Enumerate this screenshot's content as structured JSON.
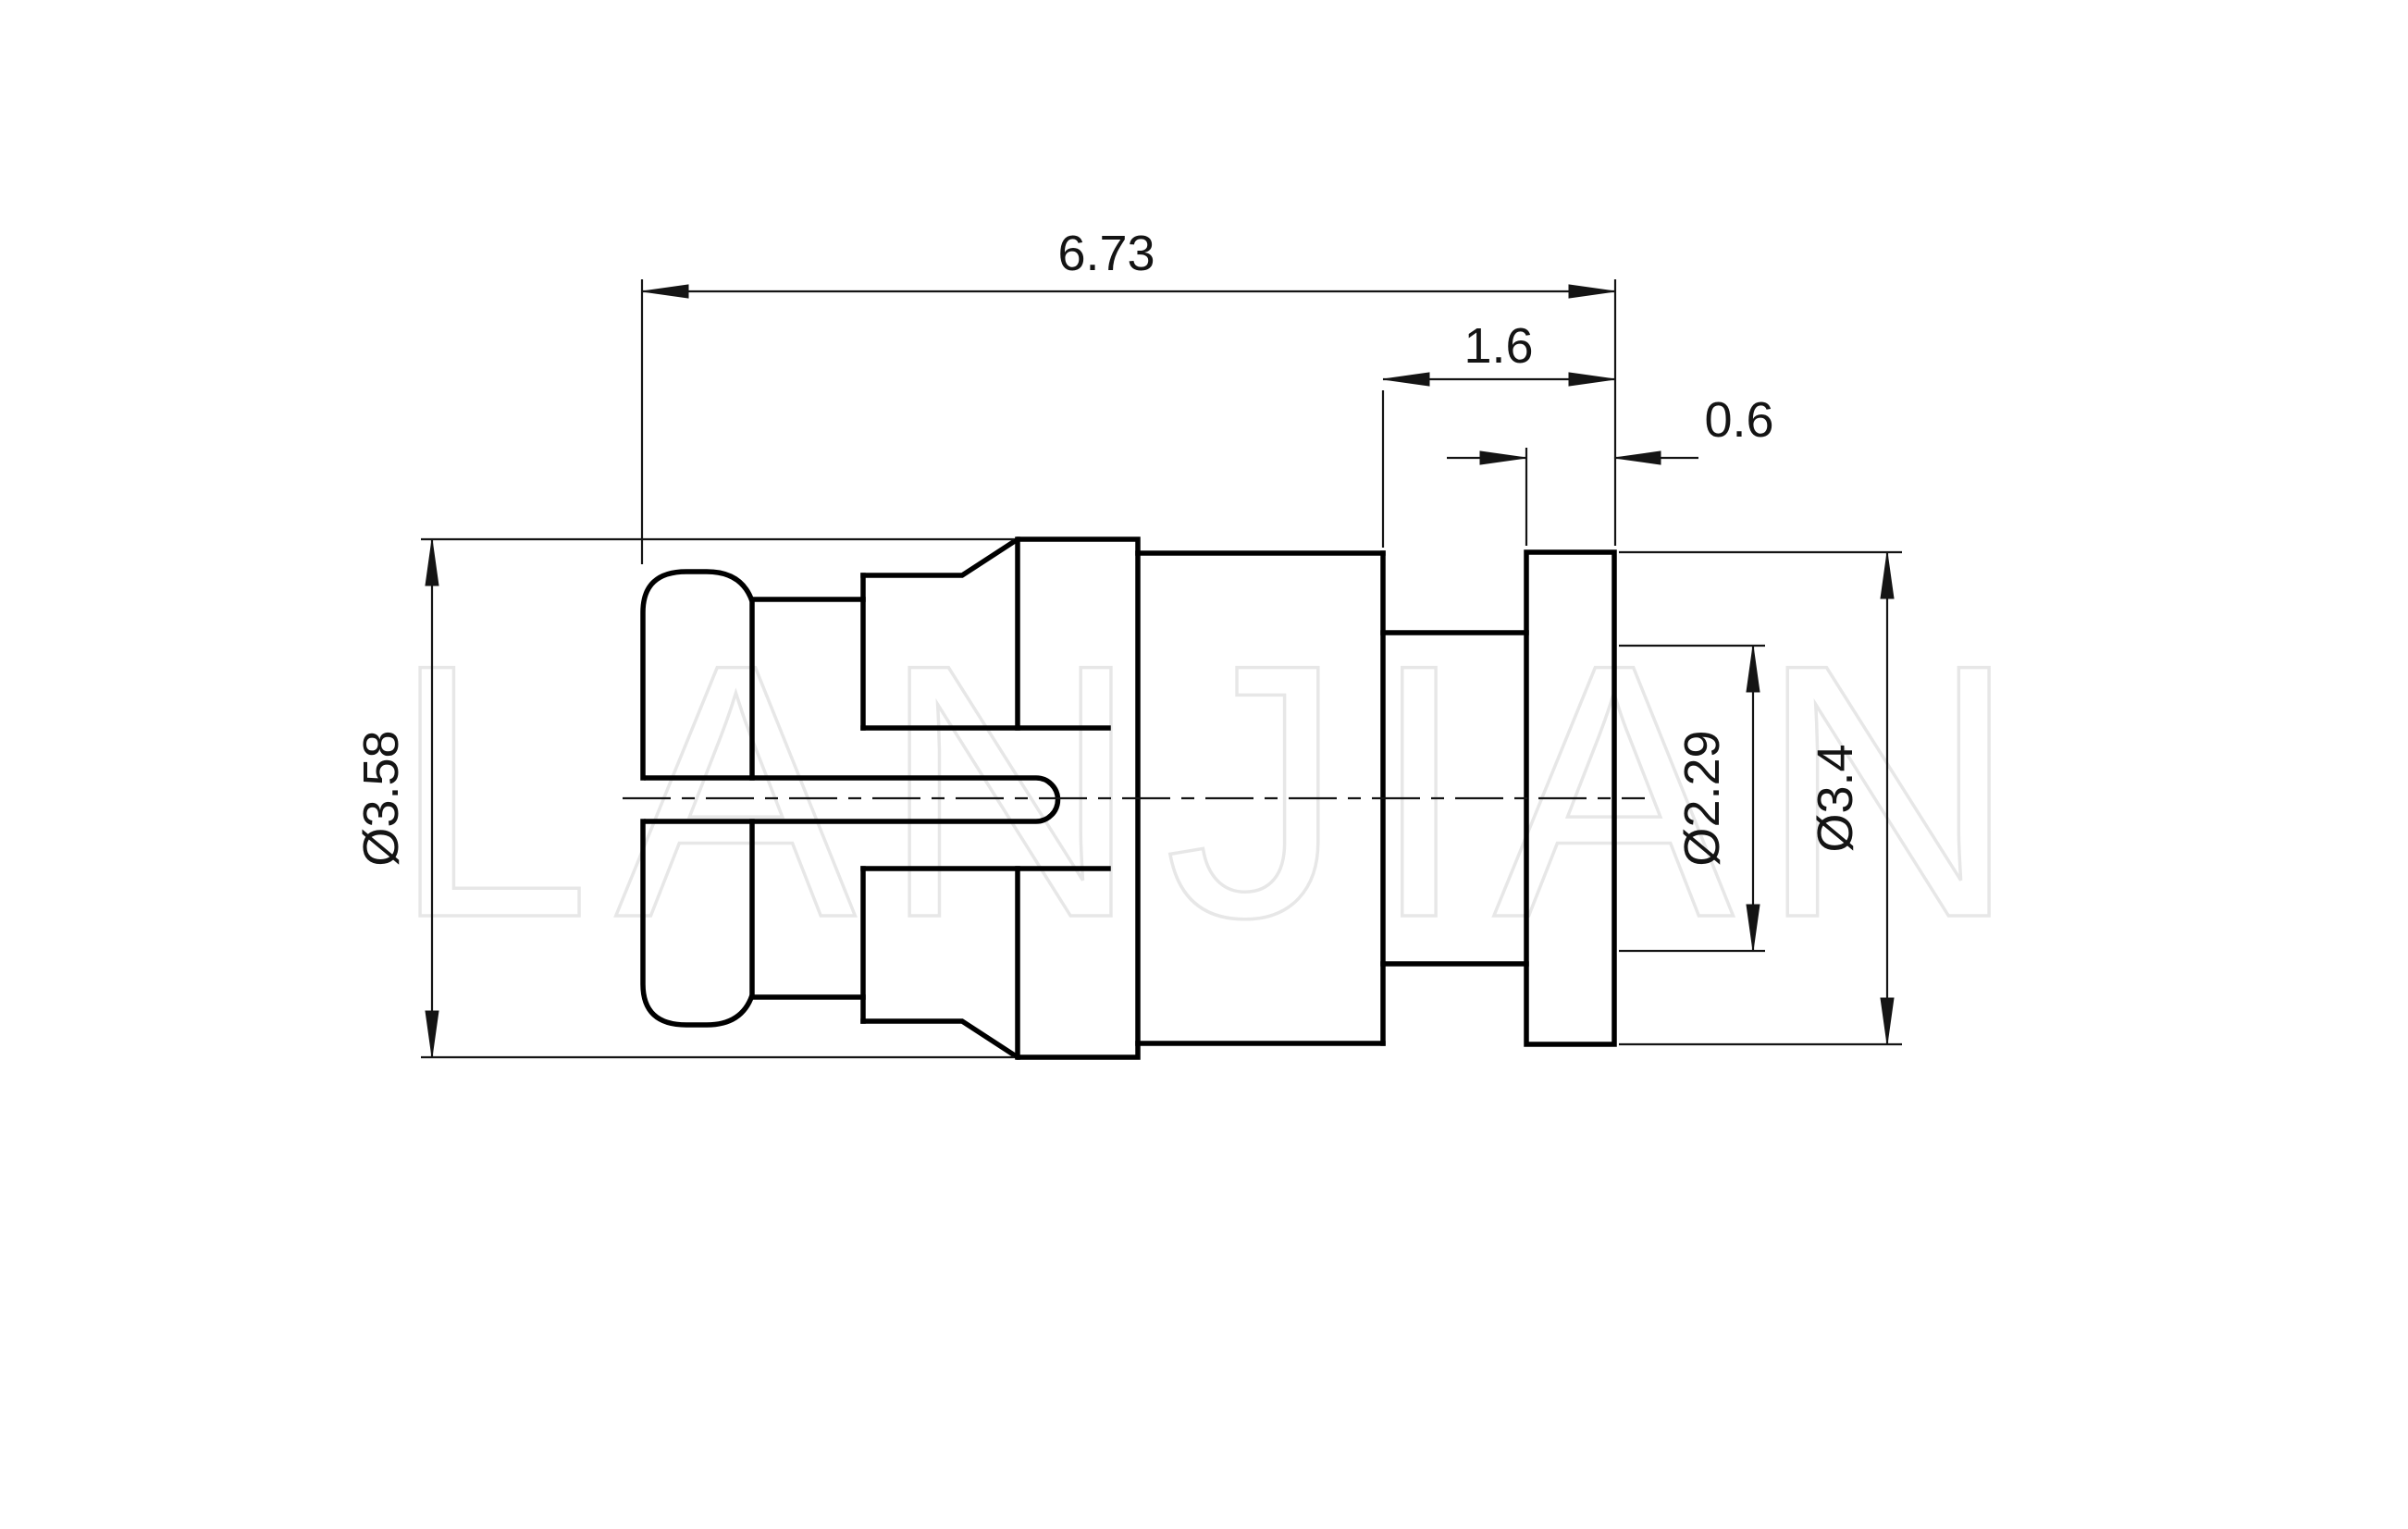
{
  "drawing": {
    "watermark_text": "LANJIAN",
    "dimensions": {
      "overall_length": {
        "label": "6.73"
      },
      "rear_section_length": {
        "label": "1.6"
      },
      "flange_thickness": {
        "label": "0.6"
      },
      "sleeve_diameter": {
        "label": "Ø3.58"
      },
      "bore_diameter": {
        "label": "Ø2.29"
      },
      "flange_diameter": {
        "label": "Ø3.4"
      }
    },
    "colors": {
      "line": "#000000",
      "dim_line": "#141414",
      "background": "#ffffff",
      "watermark_outline": "#e7e7e7"
    }
  }
}
